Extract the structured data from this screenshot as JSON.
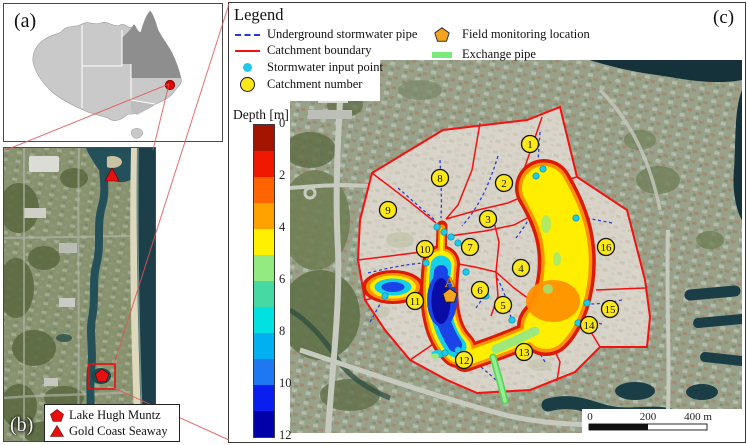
{
  "figure": {
    "panel_a_label": "(a)",
    "panel_b_label": "(b)",
    "panel_c_label": "(c)"
  },
  "legend": {
    "title": "Legend",
    "items": [
      {
        "id": "underground-stormwater-pipe",
        "label": "Underground stormwater pipe"
      },
      {
        "id": "catchment-boundary",
        "label": "Catchment boundary"
      },
      {
        "id": "stormwater-input-point",
        "label": "Stormwater input point"
      },
      {
        "id": "catchment-number",
        "label": "Catchment number"
      },
      {
        "id": "field-monitoring-location",
        "label": "Field monitoring location"
      },
      {
        "id": "exchange-pipe",
        "label": "Exchange pipe"
      }
    ]
  },
  "map_b_legend": {
    "items": [
      {
        "symbol": "pentagon",
        "label": "Lake Hugh Muntz"
      },
      {
        "symbol": "triangle",
        "label": "Gold Coast Seaway"
      }
    ]
  },
  "colorbar": {
    "title": "Depth [m]",
    "tick_labels": [
      "0",
      "2",
      "4",
      "6",
      "8",
      "10",
      "12"
    ],
    "segment_colors": [
      "#a31500",
      "#f01800",
      "#ff6400",
      "#ffa200",
      "#fff000",
      "#93ea80",
      "#46d9a4",
      "#00e2e2",
      "#00b0f0",
      "#1e78f2",
      "#0b1ef0",
      "#0000a8"
    ]
  },
  "site": {
    "label": "A"
  },
  "scalebar": {
    "labels": [
      "0",
      "200",
      "400 m"
    ]
  },
  "catchments": [
    {
      "n": "1",
      "x": 240,
      "y": 84
    },
    {
      "n": "2",
      "x": 214,
      "y": 123
    },
    {
      "n": "3",
      "x": 198,
      "y": 159
    },
    {
      "n": "4",
      "x": 231,
      "y": 208
    },
    {
      "n": "5",
      "x": 213,
      "y": 245
    },
    {
      "n": "6",
      "x": 190,
      "y": 230
    },
    {
      "n": "7",
      "x": 180,
      "y": 187
    },
    {
      "n": "8",
      "x": 150,
      "y": 118
    },
    {
      "n": "9",
      "x": 98,
      "y": 150
    },
    {
      "n": "10",
      "x": 135,
      "y": 189
    },
    {
      "n": "11",
      "x": 125,
      "y": 241
    },
    {
      "n": "12",
      "x": 174,
      "y": 300
    },
    {
      "n": "13",
      "x": 234,
      "y": 292
    },
    {
      "n": "14",
      "x": 299,
      "y": 265
    },
    {
      "n": "15",
      "x": 320,
      "y": 249
    },
    {
      "n": "16",
      "x": 316,
      "y": 187
    }
  ],
  "input_points": [
    [
      147,
      167
    ],
    [
      154,
      172
    ],
    [
      161,
      177
    ],
    [
      168,
      183
    ],
    [
      176,
      212
    ],
    [
      95,
      236
    ],
    [
      136,
      203
    ],
    [
      168,
      290
    ],
    [
      196,
      236
    ],
    [
      222,
      260
    ],
    [
      246,
      116
    ],
    [
      253,
      109
    ],
    [
      286,
      158
    ],
    [
      297,
      243
    ],
    [
      288,
      263
    ],
    [
      155,
      293
    ]
  ],
  "colors": {
    "catchment_boundary": "#f21212",
    "underground_pipe": "#2438d8",
    "stormwater_input": "#1fc9e9",
    "catchment_circle": "#ffe81a",
    "monitoring_marker": "#f5a51d",
    "exchange_pipe": "#7de87d",
    "locator_marker": "#e80f0f",
    "queensland_fill": "#8e8e8e"
  }
}
